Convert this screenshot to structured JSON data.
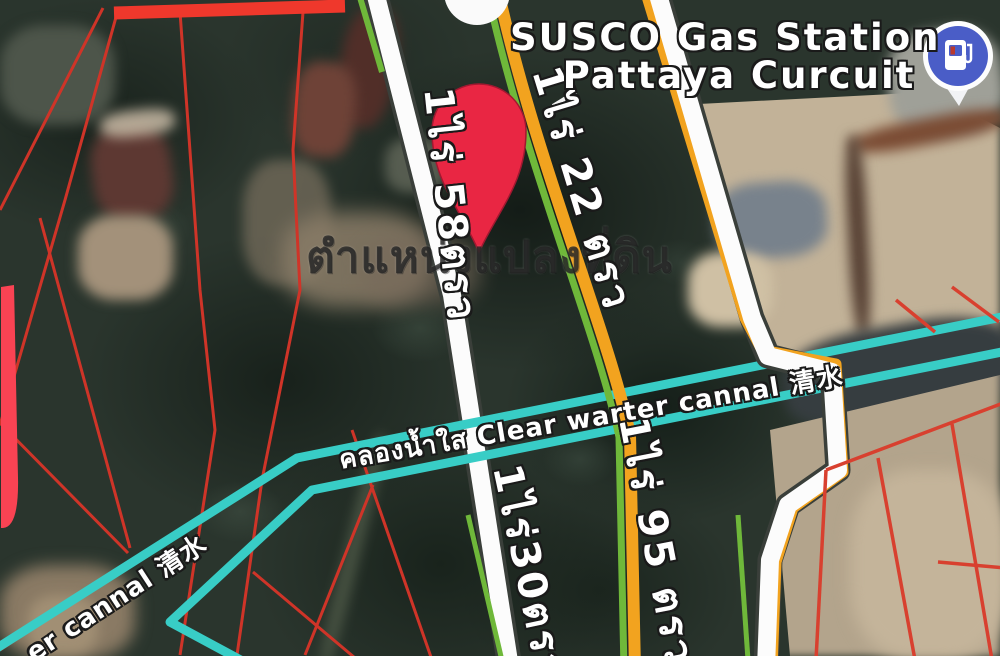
{
  "map": {
    "poi_gas_station": {
      "name_line1": "SUSCO Gas Station",
      "name_line2": "Pattaya Curcuit",
      "icon": "gas-pump-icon",
      "icon_bg_color": "#4a5dc7"
    },
    "location_pin": {
      "color": "#e92643"
    },
    "plots": [
      {
        "label": "1ไร่ 58ตรว"
      },
      {
        "label": "1ไร่ 22 ตรว"
      },
      {
        "label": "1ไร่30ตรว"
      },
      {
        "label": "1ไร่ 95 ตรว"
      }
    ],
    "canal": {
      "main_label": "คลองน้ำใส Clear warter cannal 清水",
      "branch_label": "er cannal 清水",
      "color": "#38cdc6"
    },
    "watermark": "ตำแหน่งแปลงที่ดิน",
    "colors": {
      "parcel_boundary_red": "#cf3428",
      "highlight_red_bar": "#f94353",
      "road_white": "#fcfcfc",
      "line_orange": "#f2a31f",
      "line_green": "#6fb83a"
    }
  }
}
